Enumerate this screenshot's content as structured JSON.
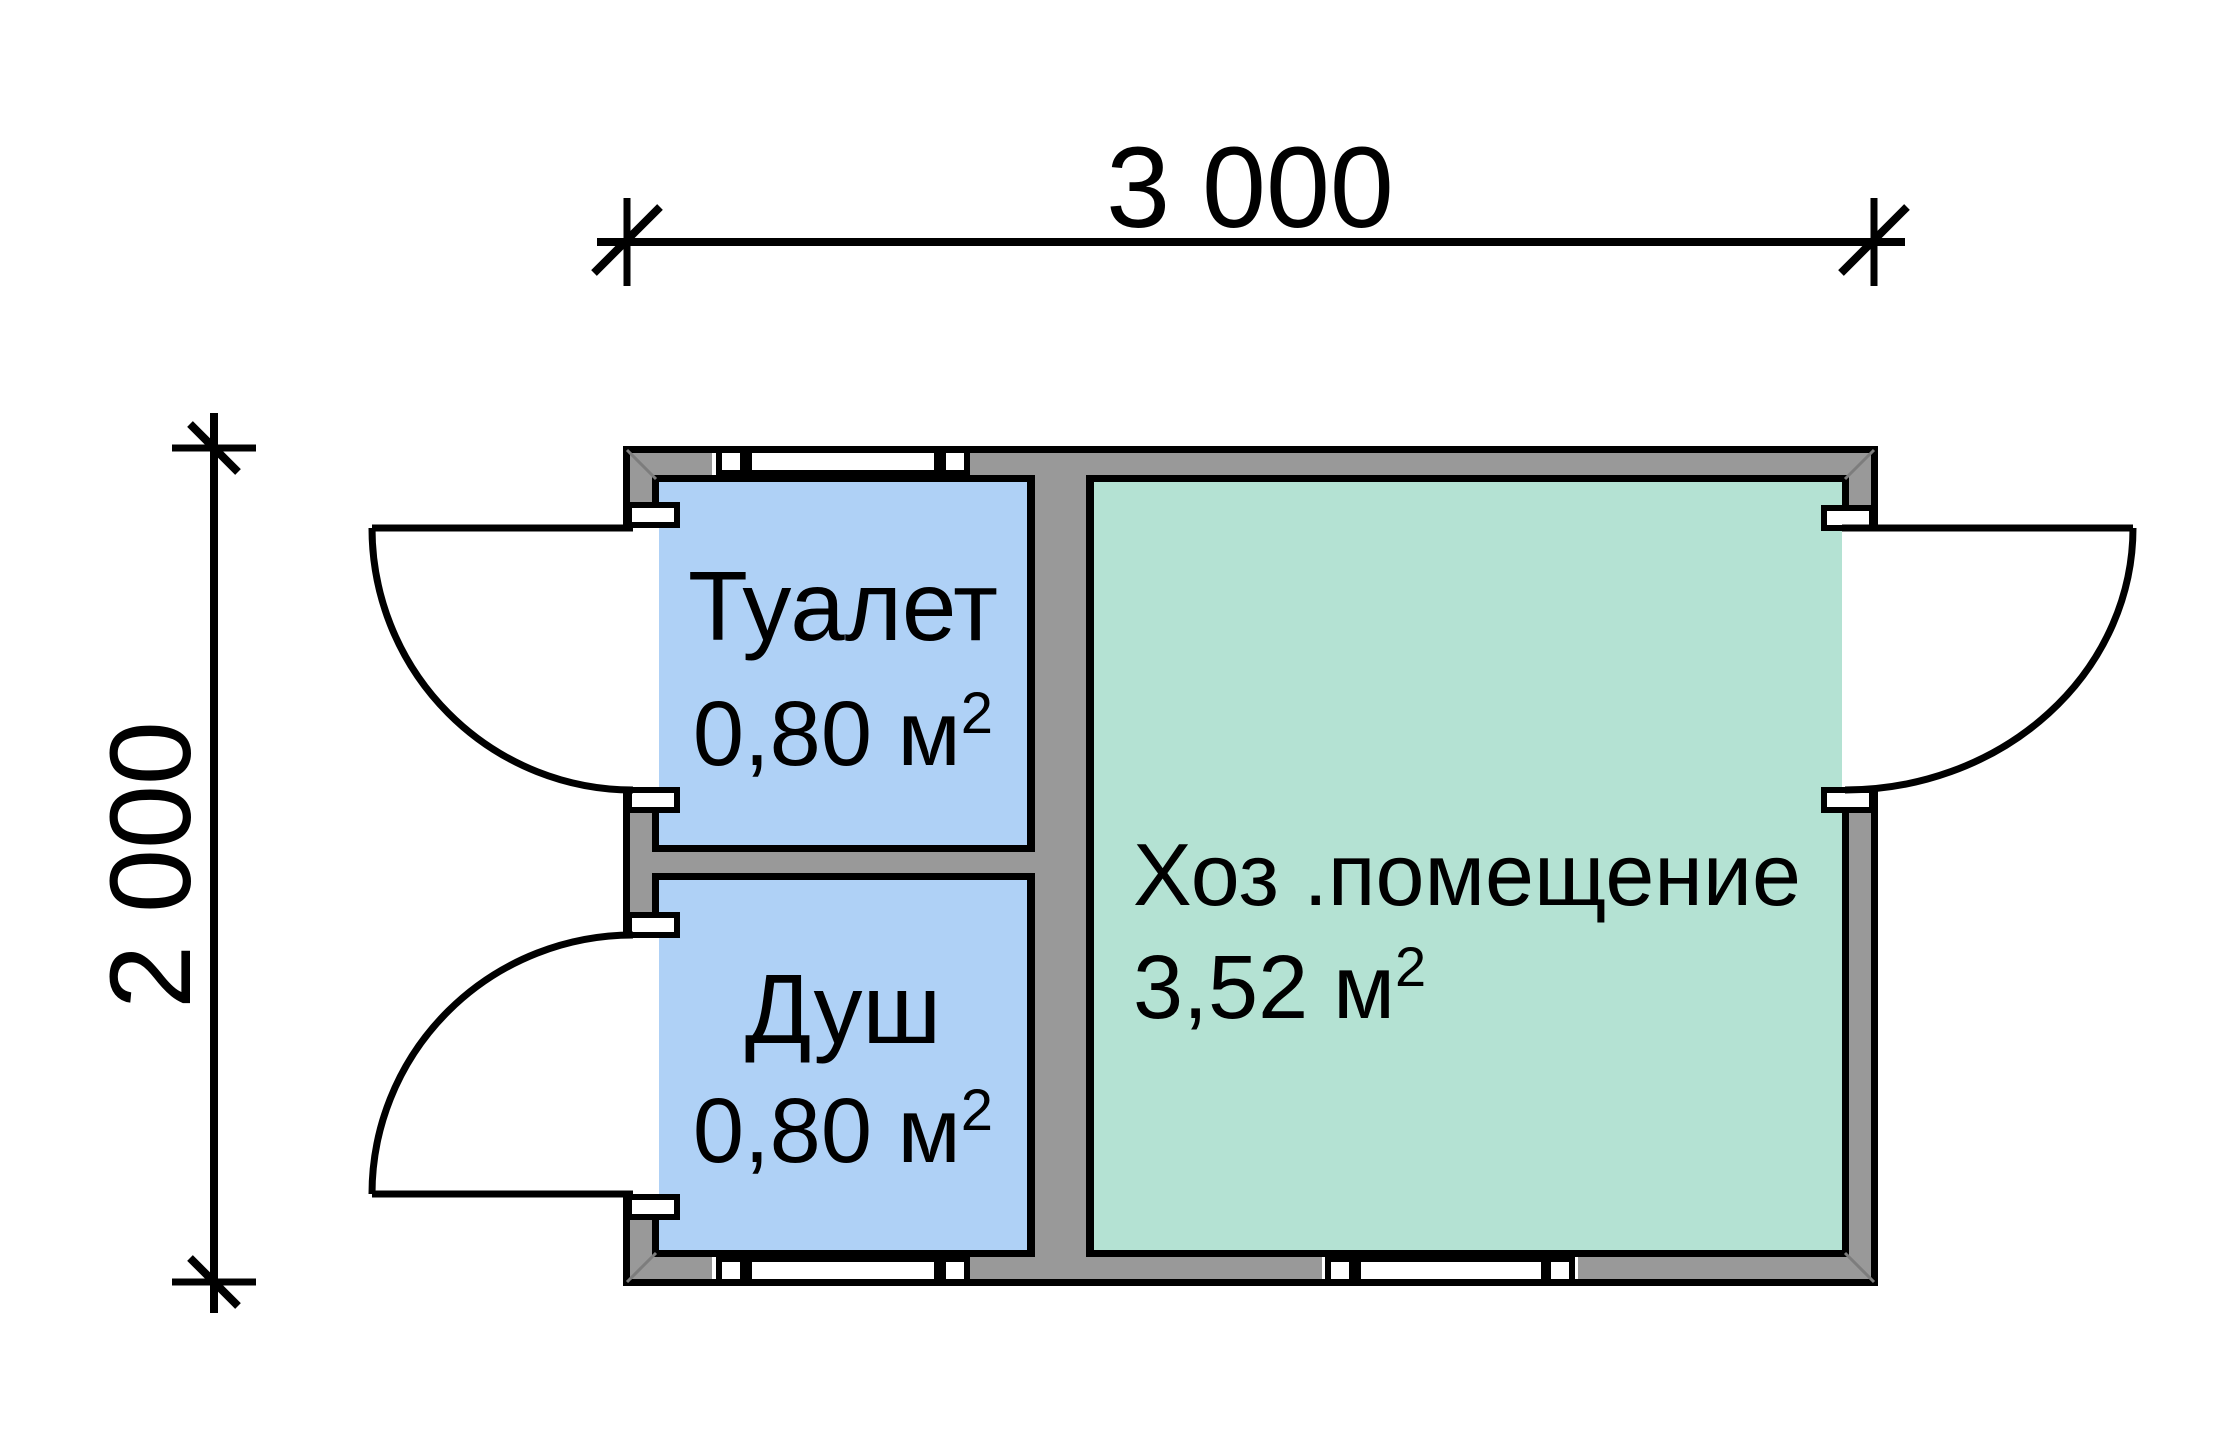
{
  "dimensions": {
    "width_label": "3 000",
    "height_label": "2 000"
  },
  "rooms": [
    {
      "name": "Туалет",
      "area": "0,80 м",
      "area_sup": "2"
    },
    {
      "name": "Душ",
      "area": "0,80 м",
      "area_sup": "2"
    },
    {
      "name": "Хоз .помещение",
      "area": "3,52 м",
      "area_sup": "2"
    }
  ],
  "colors": {
    "wet_room_fill": "#afd1f6",
    "utility_fill": "#b4e2d3",
    "wall_fill": "#999999",
    "outline": "#000000",
    "background": "#ffffff"
  }
}
